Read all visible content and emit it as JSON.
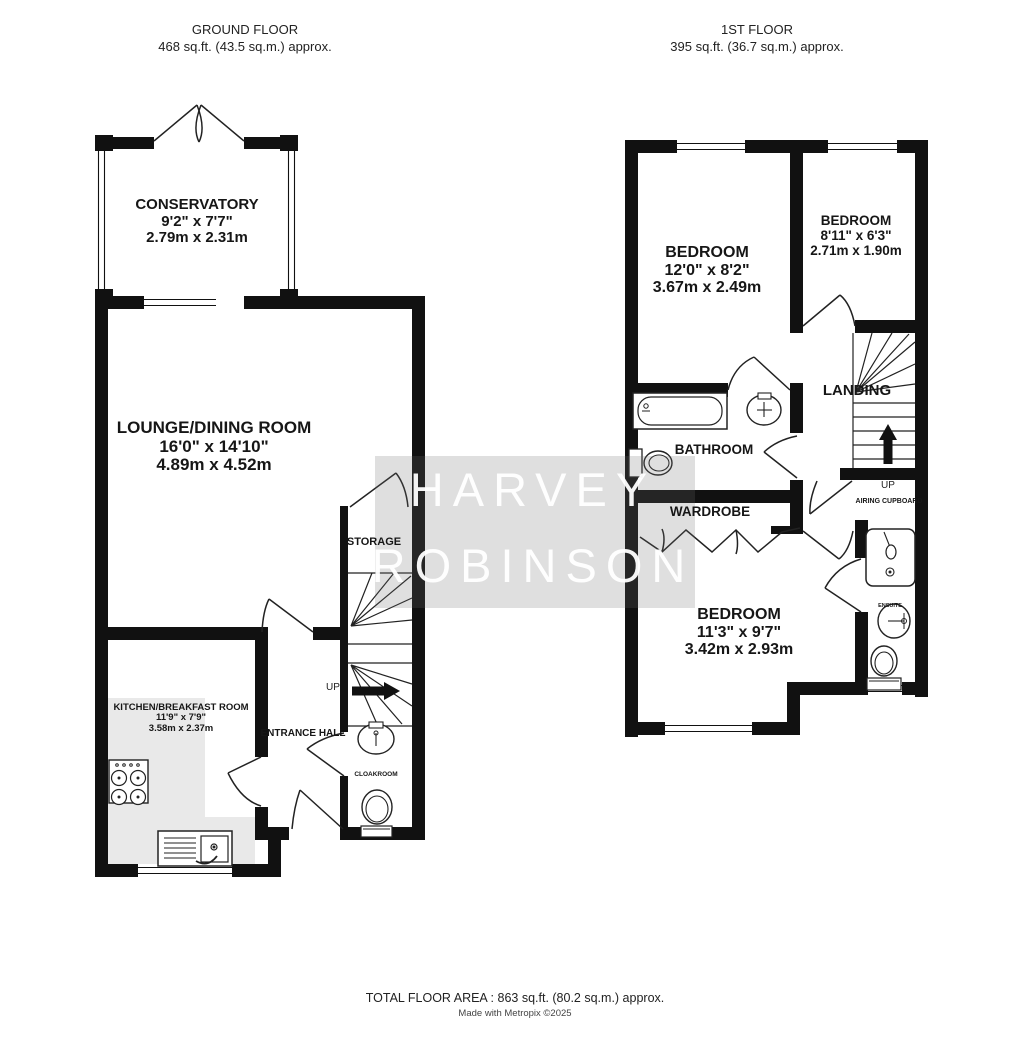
{
  "header": {
    "ground": {
      "title": "GROUND FLOOR",
      "area": "468 sq.ft. (43.5 sq.m.) approx."
    },
    "first": {
      "title": "1ST FLOOR",
      "area": "395 sq.ft. (36.7 sq.m.) approx."
    }
  },
  "rooms": {
    "conservatory": {
      "name": "CONSERVATORY",
      "imperial": "9'2\" x 7'7\"",
      "metric": "2.79m x 2.31m"
    },
    "lounge": {
      "name": "LOUNGE/DINING ROOM",
      "imperial": "16'0\" x 14'10\"",
      "metric": "4.89m x 4.52m"
    },
    "kitchen": {
      "name": "KITCHEN/BREAKFAST ROOM",
      "imperial": "11'9\" x 7'9\"",
      "metric": "3.58m x 2.37m"
    },
    "bedroom1": {
      "name": "BEDROOM",
      "imperial": "12'0\" x 8'2\"",
      "metric": "3.67m x 2.49m"
    },
    "bedroom2": {
      "name": "BEDROOM",
      "imperial": "8'11\" x 6'3\"",
      "metric": "2.71m x 1.90m"
    },
    "bedroom3": {
      "name": "BEDROOM",
      "imperial": "11'3\" x 9'7\"",
      "metric": "3.42m x 2.93m"
    }
  },
  "labels": {
    "storage": "STORAGE",
    "entrance_hall": "ENTRANCE HALL",
    "cloakroom": "CLOAKROOM",
    "bathroom": "BATHROOM",
    "wardrobe": "WARDROBE",
    "landing": "LANDING",
    "airing_cupboard": "AIRING CUPBOARD",
    "ensuite": "ENSUITE",
    "up_ground": "UP",
    "up_first": "UP"
  },
  "watermark": {
    "line1": "HARVEY",
    "line2": "ROBINSON"
  },
  "footer": {
    "total": "TOTAL FLOOR AREA : 863 sq.ft. (80.2 sq.m.) approx.",
    "credit": "Made with Metropix ©2025"
  },
  "colors": {
    "wall": "#111111",
    "counter": "#e9e9e9",
    "watermark_text": "#ffffff"
  }
}
